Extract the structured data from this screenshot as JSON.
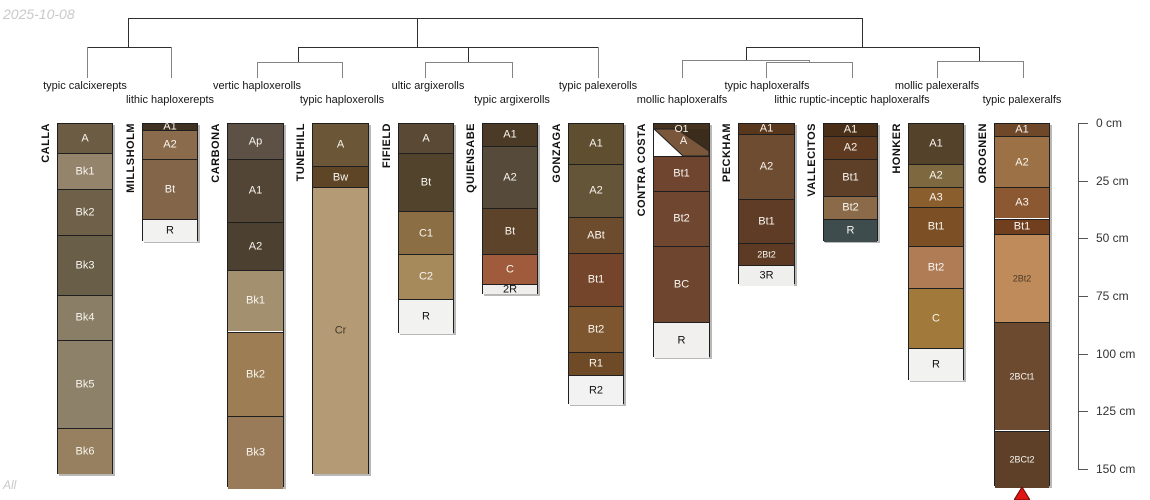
{
  "watermarks": {
    "date": "2025-10-08",
    "page": "All"
  },
  "depth_axis": {
    "origin_y": 123,
    "px_per_cm": 2.3067,
    "line_x": 1078,
    "tick_len": 10,
    "label_x": 1096,
    "unit": "cm",
    "ticks": [
      {
        "label": "0 cm",
        "cm": 0
      },
      {
        "label": "25 cm",
        "cm": 25
      },
      {
        "label": "50 cm",
        "cm": 50
      },
      {
        "label": "75 cm",
        "cm": 75
      },
      {
        "label": "100 cm",
        "cm": 100
      },
      {
        "label": "125 cm",
        "cm": 125
      },
      {
        "label": "150 cm",
        "cm": 150
      }
    ]
  },
  "marker": {
    "shape": "triangle-up",
    "color": "#e31414",
    "stroke": "#6b0a0a",
    "x": 1022,
    "y": 487,
    "w": 16,
    "h": 13
  },
  "chart_data": {
    "type": "soil-profile-dendrogram",
    "depth_unit": "cm",
    "depth_range": [
      0,
      150
    ],
    "taxa_labels": [
      {
        "label": "typic calcixerepts",
        "x": 85,
        "row": 1
      },
      {
        "label": "lithic haploxerepts",
        "x": 170,
        "row": 2
      },
      {
        "label": "vertic haploxerolls",
        "x": 257,
        "row": 1
      },
      {
        "label": "typic haploxerolls",
        "x": 342,
        "row": 2
      },
      {
        "label": "ultic argixerolls",
        "x": 428,
        "row": 1
      },
      {
        "label": "typic argixerolls",
        "x": 512,
        "row": 2
      },
      {
        "label": "typic palexerolls",
        "x": 598,
        "row": 1
      },
      {
        "label": "mollic haploxeralfs",
        "x": 682,
        "row": 2
      },
      {
        "label": "typic haploxeralfs",
        "x": 767,
        "row": 1
      },
      {
        "label": "lithic ruptic-inceptic haploxeralfs",
        "x": 852,
        "row": 2
      },
      {
        "label": "mollic palexeralfs",
        "x": 937,
        "row": 1
      },
      {
        "label": "typic palexeralfs",
        "x": 1022,
        "row": 2
      }
    ],
    "taxa_row_y": {
      "row1": 80,
      "row2": 94
    },
    "dendrogram_segments": [
      {
        "x1": 128,
        "y1": 18,
        "x2": 862,
        "y2": 18,
        "c": "dark"
      },
      {
        "x1": 128,
        "y1": 18,
        "x2": 128,
        "y2": 47,
        "c": "dark"
      },
      {
        "x1": 417,
        "y1": 18,
        "x2": 417,
        "y2": 47,
        "c": "dark"
      },
      {
        "x1": 862,
        "y1": 18,
        "x2": 862,
        "y2": 47,
        "c": "dark"
      },
      {
        "x1": 87,
        "y1": 47,
        "x2": 171,
        "y2": 47,
        "c": "dark"
      },
      {
        "x1": 298,
        "y1": 47,
        "x2": 598,
        "y2": 47,
        "c": "dark"
      },
      {
        "x1": 746,
        "y1": 47,
        "x2": 979,
        "y2": 47,
        "c": "dark"
      },
      {
        "x1": 298,
        "y1": 47,
        "x2": 298,
        "y2": 62,
        "c": "dark"
      },
      {
        "x1": 468,
        "y1": 47,
        "x2": 468,
        "y2": 62,
        "c": "dark"
      },
      {
        "x1": 746,
        "y1": 47,
        "x2": 746,
        "y2": 60,
        "c": "dark"
      },
      {
        "x1": 979,
        "y1": 47,
        "x2": 979,
        "y2": 61,
        "c": "dark"
      },
      {
        "x1": 87,
        "y1": 47,
        "x2": 87,
        "y2": 77,
        "c": "gray"
      },
      {
        "x1": 171,
        "y1": 47,
        "x2": 171,
        "y2": 77,
        "c": "gray"
      },
      {
        "x1": 598,
        "y1": 47,
        "x2": 598,
        "y2": 77,
        "c": "gray"
      },
      {
        "x1": 257,
        "y1": 62,
        "x2": 342,
        "y2": 62,
        "c": "gray"
      },
      {
        "x1": 257,
        "y1": 62,
        "x2": 257,
        "y2": 77,
        "c": "gray"
      },
      {
        "x1": 342,
        "y1": 62,
        "x2": 342,
        "y2": 77,
        "c": "gray"
      },
      {
        "x1": 425,
        "y1": 62,
        "x2": 512,
        "y2": 62,
        "c": "gray"
      },
      {
        "x1": 425,
        "y1": 62,
        "x2": 425,
        "y2": 77,
        "c": "gray"
      },
      {
        "x1": 512,
        "y1": 62,
        "x2": 512,
        "y2": 77,
        "c": "gray"
      },
      {
        "x1": 682,
        "y1": 60,
        "x2": 809,
        "y2": 60,
        "c": "gray"
      },
      {
        "x1": 682,
        "y1": 60,
        "x2": 682,
        "y2": 77,
        "c": "gray"
      },
      {
        "x1": 809,
        "y1": 60,
        "x2": 809,
        "y2": 62,
        "c": "gray"
      },
      {
        "x1": 766,
        "y1": 62,
        "x2": 852,
        "y2": 62,
        "c": "gray"
      },
      {
        "x1": 766,
        "y1": 62,
        "x2": 766,
        "y2": 77,
        "c": "gray"
      },
      {
        "x1": 852,
        "y1": 62,
        "x2": 852,
        "y2": 77,
        "c": "gray"
      },
      {
        "x1": 937,
        "y1": 61,
        "x2": 1023,
        "y2": 61,
        "c": "gray"
      },
      {
        "x1": 937,
        "y1": 61,
        "x2": 937,
        "y2": 77,
        "c": "gray"
      },
      {
        "x1": 1023,
        "y1": 61,
        "x2": 1023,
        "y2": 77,
        "c": "gray"
      }
    ],
    "profiles": [
      {
        "name": "CALLA",
        "taxon": "typic calcixerepts",
        "x": 57,
        "width": 56,
        "horizons": [
          {
            "name": "A",
            "top": 0,
            "bottom": 12.5,
            "color": "#6d5c44",
            "tc": "#f8f5ef"
          },
          {
            "name": "Bk1",
            "top": 12.5,
            "bottom": 28,
            "color": "#94846c",
            "tc": "#f8f5ef"
          },
          {
            "name": "Bk2",
            "top": 28,
            "bottom": 48,
            "color": "#6f6049",
            "tc": "#f8f5ef"
          },
          {
            "name": "Bk3",
            "top": 48,
            "bottom": 74,
            "color": "#695e48",
            "tc": "#f8f5ef"
          },
          {
            "name": "Bk4",
            "top": 74,
            "bottom": 93.5,
            "color": "#8a7e66",
            "tc": "#f8f5ef"
          },
          {
            "name": "Bk5",
            "top": 93.5,
            "bottom": 132,
            "color": "#8d8169",
            "tc": "#f8f5ef"
          },
          {
            "name": "Bk6",
            "top": 132,
            "bottom": 152,
            "color": "#97805f",
            "tc": "#f8f5ef"
          }
        ]
      },
      {
        "name": "MILLSHOLM",
        "taxon": "lithic haploxerepts",
        "x": 142,
        "width": 56,
        "horizons": [
          {
            "name": "A1",
            "top": 0,
            "bottom": 2.5,
            "color": "#3f3223",
            "tc": "#f8f5ef"
          },
          {
            "name": "A2",
            "top": 2.5,
            "bottom": 15,
            "color": "#8a6b4b",
            "tc": "#f8f5ef"
          },
          {
            "name": "Bt",
            "top": 15,
            "bottom": 41,
            "color": "#83654a",
            "tc": "#f8f5ef"
          },
          {
            "name": "R",
            "top": 41,
            "bottom": 51,
            "color": "#f2f2f1",
            "tc": "#111111"
          }
        ]
      },
      {
        "name": "CARBONA",
        "taxon": "vertic haploxerolls",
        "x": 227,
        "width": 57,
        "horizons": [
          {
            "name": "Ap",
            "top": 0,
            "bottom": 15,
            "color": "#5c5144",
            "tc": "#f8f5ef"
          },
          {
            "name": "A1",
            "top": 15,
            "bottom": 42.5,
            "color": "#524535",
            "tc": "#f8f5ef"
          },
          {
            "name": "A2",
            "top": 42.5,
            "bottom": 63.5,
            "color": "#4c4031",
            "tc": "#f8f5ef"
          },
          {
            "name": "Bk1",
            "top": 63.5,
            "bottom": 90,
            "color": "#a3906f",
            "tc": "#f8f5ef"
          },
          {
            "name": "Bk2",
            "top": 90,
            "bottom": 126.5,
            "color": "#9d7e54",
            "tc": "#f8f5ef"
          },
          {
            "name": "Bk3",
            "top": 126.5,
            "bottom": 158,
            "color": "#997b5a",
            "tc": "#f8f5ef"
          }
        ]
      },
      {
        "name": "TUNEHILL",
        "taxon": "typic haploxerolls",
        "x": 312,
        "width": 57,
        "horizons": [
          {
            "name": "A",
            "top": 0,
            "bottom": 18,
            "color": "#6b5638",
            "tc": "#f8f5ef"
          },
          {
            "name": "Bw",
            "top": 18,
            "bottom": 27.5,
            "color": "#5e4526",
            "tc": "#f8f5ef"
          },
          {
            "name": "Cr",
            "top": 27.5,
            "bottom": 152,
            "color": "#b59b75",
            "tc": "#42372a"
          }
        ]
      },
      {
        "name": "FIFIELD",
        "taxon": "ultic argixerolls",
        "x": 398,
        "width": 56,
        "horizons": [
          {
            "name": "A",
            "top": 0,
            "bottom": 12.5,
            "color": "#5a4a35",
            "tc": "#f8f5ef"
          },
          {
            "name": "Bt",
            "top": 12.5,
            "bottom": 37.5,
            "color": "#52442c",
            "tc": "#f8f5ef"
          },
          {
            "name": "C1",
            "top": 37.5,
            "bottom": 56.5,
            "color": "#8c6e44",
            "tc": "#f8f5ef"
          },
          {
            "name": "C2",
            "top": 56.5,
            "bottom": 76,
            "color": "#a68a5c",
            "tc": "#f8f5ef"
          },
          {
            "name": "R",
            "top": 76,
            "bottom": 91,
            "color": "#f2f2f0",
            "tc": "#111111"
          }
        ]
      },
      {
        "name": "QUIENSABE",
        "taxon": "typic argixerolls",
        "x": 482,
        "width": 56,
        "horizons": [
          {
            "name": "A1",
            "top": 0,
            "bottom": 9.5,
            "color": "#4a3a26",
            "tc": "#f8f5ef"
          },
          {
            "name": "A2",
            "top": 9.5,
            "bottom": 36.5,
            "color": "#564a3a",
            "tc": "#f8f5ef"
          },
          {
            "name": "Bt",
            "top": 36.5,
            "bottom": 56.5,
            "color": "#5e432b",
            "tc": "#f8f5ef"
          },
          {
            "name": "C",
            "top": 56.5,
            "bottom": 69.5,
            "color": "#a05a3c",
            "tc": "#f8f5ef"
          },
          {
            "name": "2R",
            "top": 69.5,
            "bottom": 74,
            "color": "#f0eeec",
            "tc": "#111111"
          }
        ]
      },
      {
        "name": "GONZAGA",
        "taxon": "typic palexerolls",
        "x": 568,
        "width": 56,
        "horizons": [
          {
            "name": "A1",
            "top": 0,
            "bottom": 17.5,
            "color": "#5f4e30",
            "tc": "#f8f5ef"
          },
          {
            "name": "A2",
            "top": 17.5,
            "bottom": 40.5,
            "color": "#645538",
            "tc": "#f8f5ef"
          },
          {
            "name": "ABt",
            "top": 40.5,
            "bottom": 56,
            "color": "#6d4c2e",
            "tc": "#f8f5ef"
          },
          {
            "name": "Bt1",
            "top": 56,
            "bottom": 79,
            "color": "#74452b",
            "tc": "#f8f5ef"
          },
          {
            "name": "Bt2",
            "top": 79,
            "bottom": 99,
            "color": "#7d552e",
            "tc": "#f8f5ef"
          },
          {
            "name": "R1",
            "top": 99,
            "bottom": 109,
            "color": "#6f4a26",
            "tc": "#f8f5ef"
          },
          {
            "name": "R2",
            "top": 109,
            "bottom": 122,
            "color": "#f2f2f2",
            "tc": "#111111"
          }
        ]
      },
      {
        "name": "CONTRA COSTA",
        "taxon": "mollic haploxeralfs",
        "x": 653,
        "width": 57,
        "horizons": [
          {
            "name": "A",
            "diagonal": true,
            "top": 0,
            "bottom": 13.9,
            "o1_label": "O1",
            "o1_color": "#46331d",
            "o1_bottom_frac": 0.16,
            "a_label": "A",
            "a_color": "#7a573a",
            "dark_color": "#3b2c1b",
            "bg": "#ffffff",
            "tc": "#f8f5ef"
          },
          {
            "name": "Bt1",
            "top": 13.9,
            "bottom": 29,
            "color": "#6f4530",
            "tc": "#f8f5ef"
          },
          {
            "name": "Bt2",
            "top": 29,
            "bottom": 53,
            "color": "#6f4731",
            "tc": "#f8f5ef"
          },
          {
            "name": "BC",
            "top": 53,
            "bottom": 86,
            "color": "#6e462f",
            "tc": "#f8f5ef"
          },
          {
            "name": "R",
            "top": 86,
            "bottom": 101.5,
            "color": "#f1f0ee",
            "tc": "#111111"
          }
        ]
      },
      {
        "name": "PECKHAM",
        "taxon": "typic haploxeralfs",
        "x": 738,
        "width": 57,
        "horizons": [
          {
            "name": "A1",
            "top": 0,
            "bottom": 4.5,
            "color": "#59371c",
            "tc": "#f8f5ef"
          },
          {
            "name": "A2",
            "top": 4.5,
            "bottom": 32.5,
            "color": "#6e4c31",
            "tc": "#f8f5ef"
          },
          {
            "name": "Bt1",
            "top": 32.5,
            "bottom": 51.5,
            "color": "#5f3c26",
            "tc": "#f8f5ef"
          },
          {
            "name": "2Bt2",
            "top": 51.5,
            "bottom": 61,
            "color": "#5c3a23",
            "tc": "#f8f5ef",
            "small": true
          },
          {
            "name": "3R",
            "top": 61,
            "bottom": 70,
            "color": "#efefed",
            "tc": "#111111"
          }
        ]
      },
      {
        "name": "VALLECITOS",
        "taxon": "lithic ruptic-inceptic haploxeralfs",
        "x": 823,
        "width": 55,
        "horizons": [
          {
            "name": "A1",
            "top": 0,
            "bottom": 5,
            "color": "#4a2f18",
            "tc": "#f8f5ef"
          },
          {
            "name": "A2",
            "top": 5,
            "bottom": 15,
            "color": "#5d3a20",
            "tc": "#f8f5ef"
          },
          {
            "name": "Bt1",
            "top": 15,
            "bottom": 31,
            "color": "#5e3f28",
            "tc": "#f8f5ef"
          },
          {
            "name": "Bt2",
            "top": 31,
            "bottom": 41,
            "color": "#8a6a48",
            "tc": "#f8f5ef"
          },
          {
            "name": "R",
            "top": 41,
            "bottom": 51,
            "color": "#3f4c4d",
            "tc": "#f8f5ef"
          }
        ]
      },
      {
        "name": "HONKER",
        "taxon": "mollic palexeralfs",
        "x": 908,
        "width": 56,
        "horizons": [
          {
            "name": "A1",
            "top": 0,
            "bottom": 17.5,
            "color": "#54422a",
            "tc": "#f8f5ef"
          },
          {
            "name": "A2",
            "top": 17.5,
            "bottom": 27.5,
            "color": "#7e683f",
            "tc": "#f8f5ef"
          },
          {
            "name": "A3",
            "top": 27.5,
            "bottom": 36,
            "color": "#8a5e2d",
            "tc": "#f8f5ef"
          },
          {
            "name": "Bt1",
            "top": 36,
            "bottom": 53,
            "color": "#7c4f25",
            "tc": "#f8f5ef"
          },
          {
            "name": "Bt2",
            "top": 53,
            "bottom": 71,
            "color": "#b07c55",
            "tc": "#f8f5ef"
          },
          {
            "name": "C",
            "top": 71,
            "bottom": 97,
            "color": "#a1793a",
            "tc": "#f8f5ef"
          },
          {
            "name": "R",
            "top": 97,
            "bottom": 111.5,
            "color": "#f2f2f0",
            "tc": "#111111"
          }
        ]
      },
      {
        "name": "OROGNEN",
        "taxon": "typic palexeralfs",
        "x": 994,
        "width": 56,
        "horizons": [
          {
            "name": "A1",
            "top": 0,
            "bottom": 5,
            "color": "#6e4828",
            "tc": "#f8f5ef"
          },
          {
            "name": "A2",
            "top": 5,
            "bottom": 27.5,
            "color": "#9c7145",
            "tc": "#f8f5ef"
          },
          {
            "name": "A3",
            "top": 27.5,
            "bottom": 41,
            "color": "#8c5832",
            "tc": "#f8f5ef"
          },
          {
            "name": "Bt1",
            "top": 41,
            "bottom": 47.5,
            "color": "#713f1e",
            "tc": "#f8f5ef"
          },
          {
            "name": "2Bt2",
            "top": 47.5,
            "bottom": 86,
            "color": "#c08b5a",
            "tc": "#4a3a28",
            "small": true
          },
          {
            "name": "2BCt1",
            "top": 86,
            "bottom": 133,
            "color": "#6b4a30",
            "tc": "#f8f5ef",
            "small": true
          },
          {
            "name": "2BCt2",
            "top": 133,
            "bottom": 157.5,
            "color": "#5e3f28",
            "tc": "#f8f5ef",
            "small": true
          }
        ]
      }
    ]
  }
}
